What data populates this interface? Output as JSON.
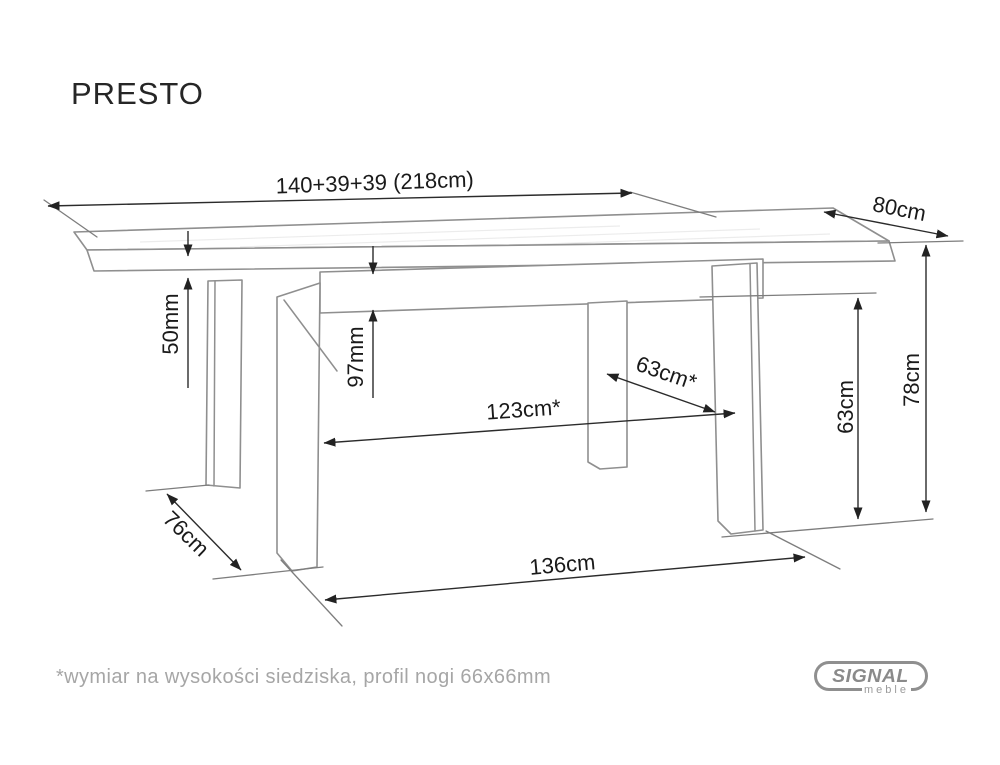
{
  "page": {
    "title": "PRESTO",
    "footnote": "*wymiar na wysokości siedziska, profil nogi 66x66mm"
  },
  "logo": {
    "brand": "SIGNAL",
    "sub": "meble"
  },
  "diagram": {
    "type": "furniture-dimension-drawing",
    "product": "PRESTO extendable dining table",
    "dimensions": {
      "total_length": "140+39+39 (218cm)",
      "top_depth": "80cm",
      "top_thickness": "50mm",
      "apron_height": "97mm",
      "diagonal_leg_clearance": "63cm*",
      "inner_leg_span": "123cm*",
      "under_clearance_height": "63cm",
      "table_height": "78cm",
      "leg_depth_span": "76cm",
      "outer_leg_span": "136cm"
    },
    "colors": {
      "drawing_line": "#8f8f8f",
      "dimension_line": "#2b2b2b",
      "label_text": "#1a1a1a",
      "muted_text": "#a6a6a6",
      "logo_gray": "#8a8a8a"
    }
  }
}
